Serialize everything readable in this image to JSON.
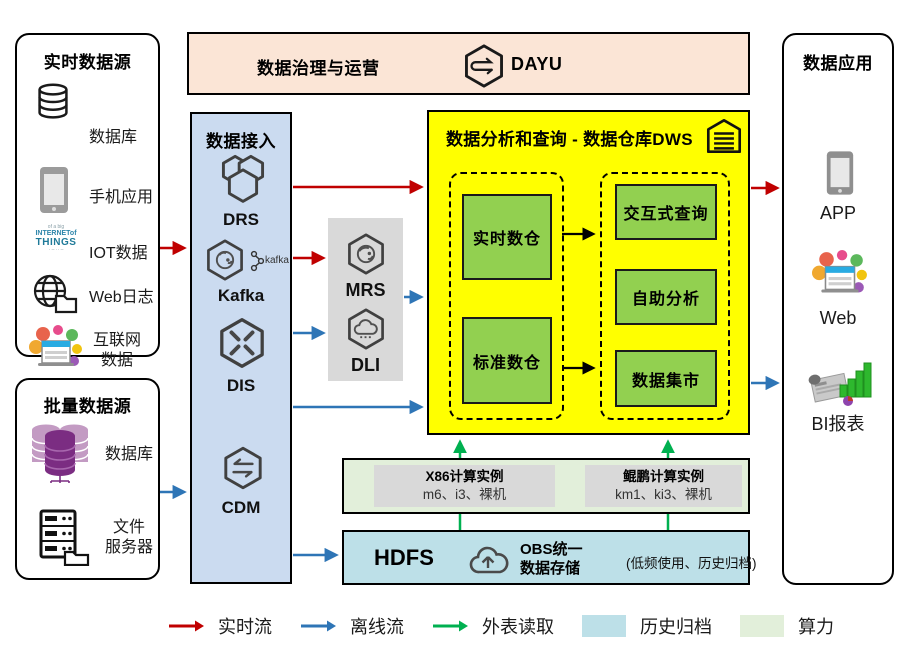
{
  "sources_realtime": {
    "title": "实时数据源",
    "items": [
      {
        "label": "数据库",
        "icon": "database-icon"
      },
      {
        "label": "手机应用",
        "icon": "phone-icon"
      },
      {
        "label": "IOT数据",
        "icon": "iot-cloud-icon"
      },
      {
        "label": "Web日志",
        "icon": "globe-folder-icon"
      },
      {
        "lines": [
          "互联网",
          "数据"
        ],
        "icon": "internet-collage-icon"
      }
    ],
    "iot_words": {
      "top": "of a big",
      "mid": "INTERNETof",
      "main": "THINGS"
    }
  },
  "sources_batch": {
    "title": "批量数据源",
    "items": [
      {
        "label": "数据库",
        "icon": "purple-database-icon"
      },
      {
        "lines": [
          "文件",
          "服务器"
        ],
        "icon": "file-server-icon"
      }
    ]
  },
  "governance": {
    "title": "数据治理与运营",
    "product": "DAYU"
  },
  "ingestion": {
    "title": "数据接入",
    "items": [
      {
        "label": "DRS",
        "icon": "drs-icon"
      },
      {
        "label": "Kafka",
        "icon": "kafka-icon",
        "mark": "kafka"
      },
      {
        "label": "DIS",
        "icon": "dis-icon"
      },
      {
        "label": "CDM",
        "icon": "cdm-icon"
      }
    ]
  },
  "processing": {
    "items": [
      {
        "label": "MRS",
        "icon": "mrs-icon"
      },
      {
        "label": "DLI",
        "icon": "dli-icon"
      }
    ]
  },
  "dws": {
    "title": "数据分析和查询 - 数据仓库DWS",
    "warehouses": [
      {
        "label": "实时数仓"
      },
      {
        "label": "标准数仓"
      }
    ],
    "services": [
      {
        "label": "交互式查询"
      },
      {
        "label": "自助分析"
      },
      {
        "label": "数据集市"
      }
    ]
  },
  "compute": {
    "x86": {
      "name": "X86计算实例",
      "spec": "m6、i3、裸机"
    },
    "kunpeng": {
      "name": "鲲鹏计算实例",
      "spec": "km1、ki3、裸机"
    }
  },
  "storage": {
    "hdfs": "HDFS",
    "obs_lines": [
      "OBS统一",
      "数据存储"
    ],
    "note": "(低频使用、历史归档)"
  },
  "applications": {
    "title": "数据应用",
    "items": [
      {
        "label": "APP",
        "icon": "phone-icon"
      },
      {
        "label": "Web",
        "icon": "internet-collage-icon"
      },
      {
        "label": "BI报表",
        "icon": "bi-report-icon"
      }
    ]
  },
  "legend": {
    "flows": [
      {
        "label": "实时流",
        "color": "#C00000"
      },
      {
        "label": "离线流",
        "color": "#2E75B6"
      },
      {
        "label": "外表读取",
        "color": "#00B050"
      }
    ],
    "swatches": [
      {
        "label": "历史归档",
        "color": "#BDE0E8"
      },
      {
        "label": "算力",
        "color": "#E2EFDA"
      }
    ]
  },
  "colors": {
    "realtime_flow": "#C00000",
    "offline_flow": "#2E75B6",
    "external_read": "#00B050",
    "archive_bg": "#BDE0E8",
    "compute_bg": "#E2EFDA",
    "warehouse_bg": "#FFFF00",
    "warehouse_node": "#92D050",
    "ingestion_bg": "#CBDBF0",
    "governance_bg": "#FBE5D6",
    "gray_panel": "#D9D9D9"
  }
}
